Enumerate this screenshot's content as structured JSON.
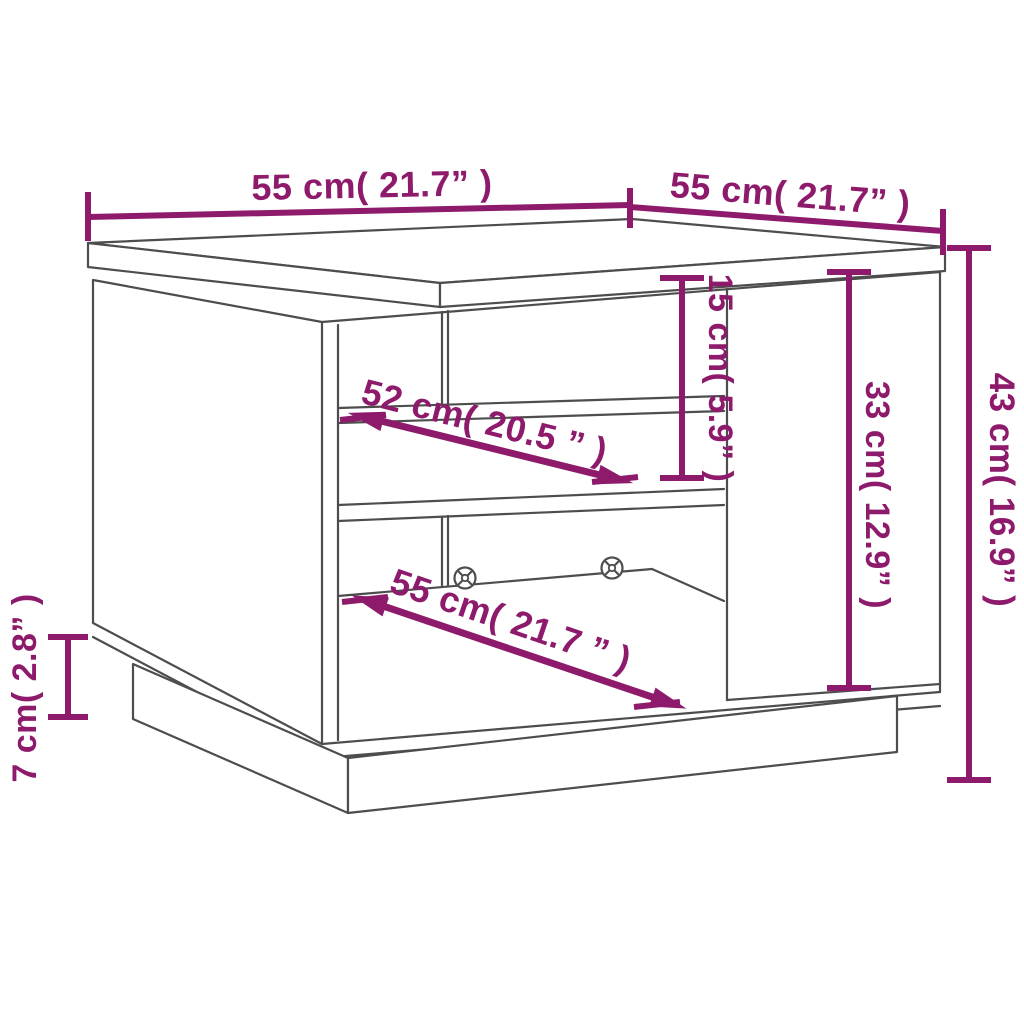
{
  "title": "Coffee table dimension diagram",
  "colors": {
    "dimension": "#8e1a6c",
    "outline": "#4d4d4d",
    "background": "#ffffff"
  },
  "dimensions": {
    "top_width": {
      "label": "55 cm( 21.7” )"
    },
    "top_depth": {
      "label": "55 cm( 21.7” )"
    },
    "overall_height": {
      "label": "43 cm( 16.9” )"
    },
    "door_height": {
      "label": "33 cm( 12.9” )"
    },
    "open_shelf_height": {
      "label": "15 cm( 5.9” )"
    },
    "plinth_height": {
      "label": "7 cm( 2.8” )"
    },
    "shelf_depth": {
      "label": "52 cm( 20.5 ” )"
    },
    "base_depth": {
      "label": "55 cm( 21.7 ” )"
    }
  }
}
